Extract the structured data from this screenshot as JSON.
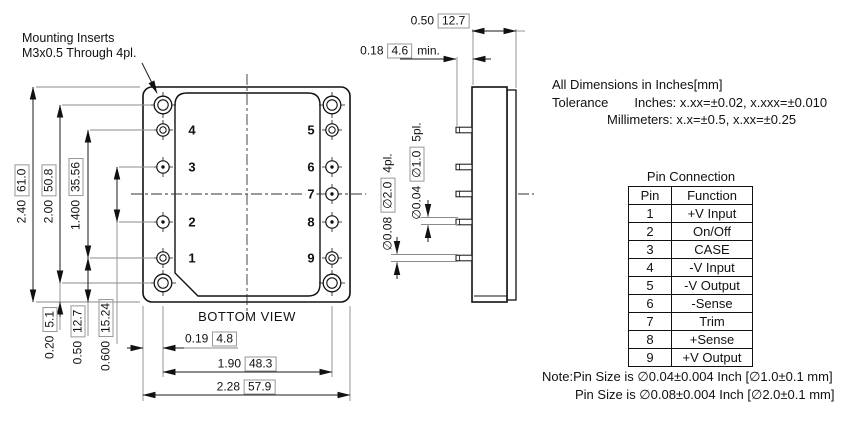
{
  "colors": {
    "ink": "#111111",
    "background": "#ffffff",
    "box_border": "#979797"
  },
  "mounting_note": {
    "line1": "Mounting Inserts",
    "line2": "M3x0.5 Through 4pl."
  },
  "views": {
    "bottom_label": "BOTTOM VIEW"
  },
  "pins": {
    "left": [
      "4",
      "3",
      "2",
      "1"
    ],
    "right": [
      "5",
      "6",
      "7",
      "8",
      "9"
    ]
  },
  "dims": {
    "overall_height": {
      "text": "2.40",
      "boxed": "61.0"
    },
    "mounting_span": {
      "text": "2.00",
      "boxed": "50.8"
    },
    "pin_span": {
      "text": "1.400",
      "boxed": "35.56"
    },
    "pin_pitch": {
      "text": "0.600",
      "boxed": "15.24"
    },
    "edge_to_hole": {
      "text": "0.20",
      "boxed": "5.1"
    },
    "edge_to_pin_row": {
      "text": "0.50",
      "boxed": "12.7"
    },
    "edge_to_pin_col": {
      "text": "0.19",
      "boxed": "4.8"
    },
    "pin_col_span": {
      "text": "1.90",
      "boxed": "48.3"
    },
    "overall_width": {
      "text": "2.28",
      "boxed": "57.9"
    },
    "case_depth": {
      "text": "0.50",
      "boxed": "12.7"
    },
    "pin_length": {
      "text": "0.18",
      "boxed": "4.6",
      "suffix": "min."
    },
    "pin_dia_large": {
      "text": "∅0.08",
      "boxed": "∅2.0",
      "suffix": "4pl."
    },
    "pin_dia_small": {
      "text": "∅0.04",
      "boxed": "∅1.0",
      "suffix": "5pl."
    }
  },
  "info_block": {
    "line1": "All Dimensions in Inches[mm]",
    "tolerance_label": "Tolerance",
    "tolerance_inches": "Inches: x.xx=±0.02, x.xxx=±0.010",
    "tolerance_mm": "Millimeters: x.x=±0.5, x.xx=±0.25"
  },
  "pin_table": {
    "title": "Pin Connection",
    "col_pin": "Pin",
    "col_function": "Function",
    "rows": [
      [
        "1",
        "+V Input"
      ],
      [
        "2",
        "On/Off"
      ],
      [
        "3",
        "CASE"
      ],
      [
        "4",
        "-V Input"
      ],
      [
        "5",
        "-V Output"
      ],
      [
        "6",
        "-Sense"
      ],
      [
        "7",
        "Trim"
      ],
      [
        "8",
        "+Sense"
      ],
      [
        "9",
        "+V Output"
      ]
    ]
  },
  "footer_notes": {
    "line1": "Note:Pin Size is ∅0.04±0.004 Inch [∅1.0±0.1 mm]",
    "line2": "Pin Size is ∅0.08±0.004 Inch [∅2.0±0.1 mm]"
  }
}
